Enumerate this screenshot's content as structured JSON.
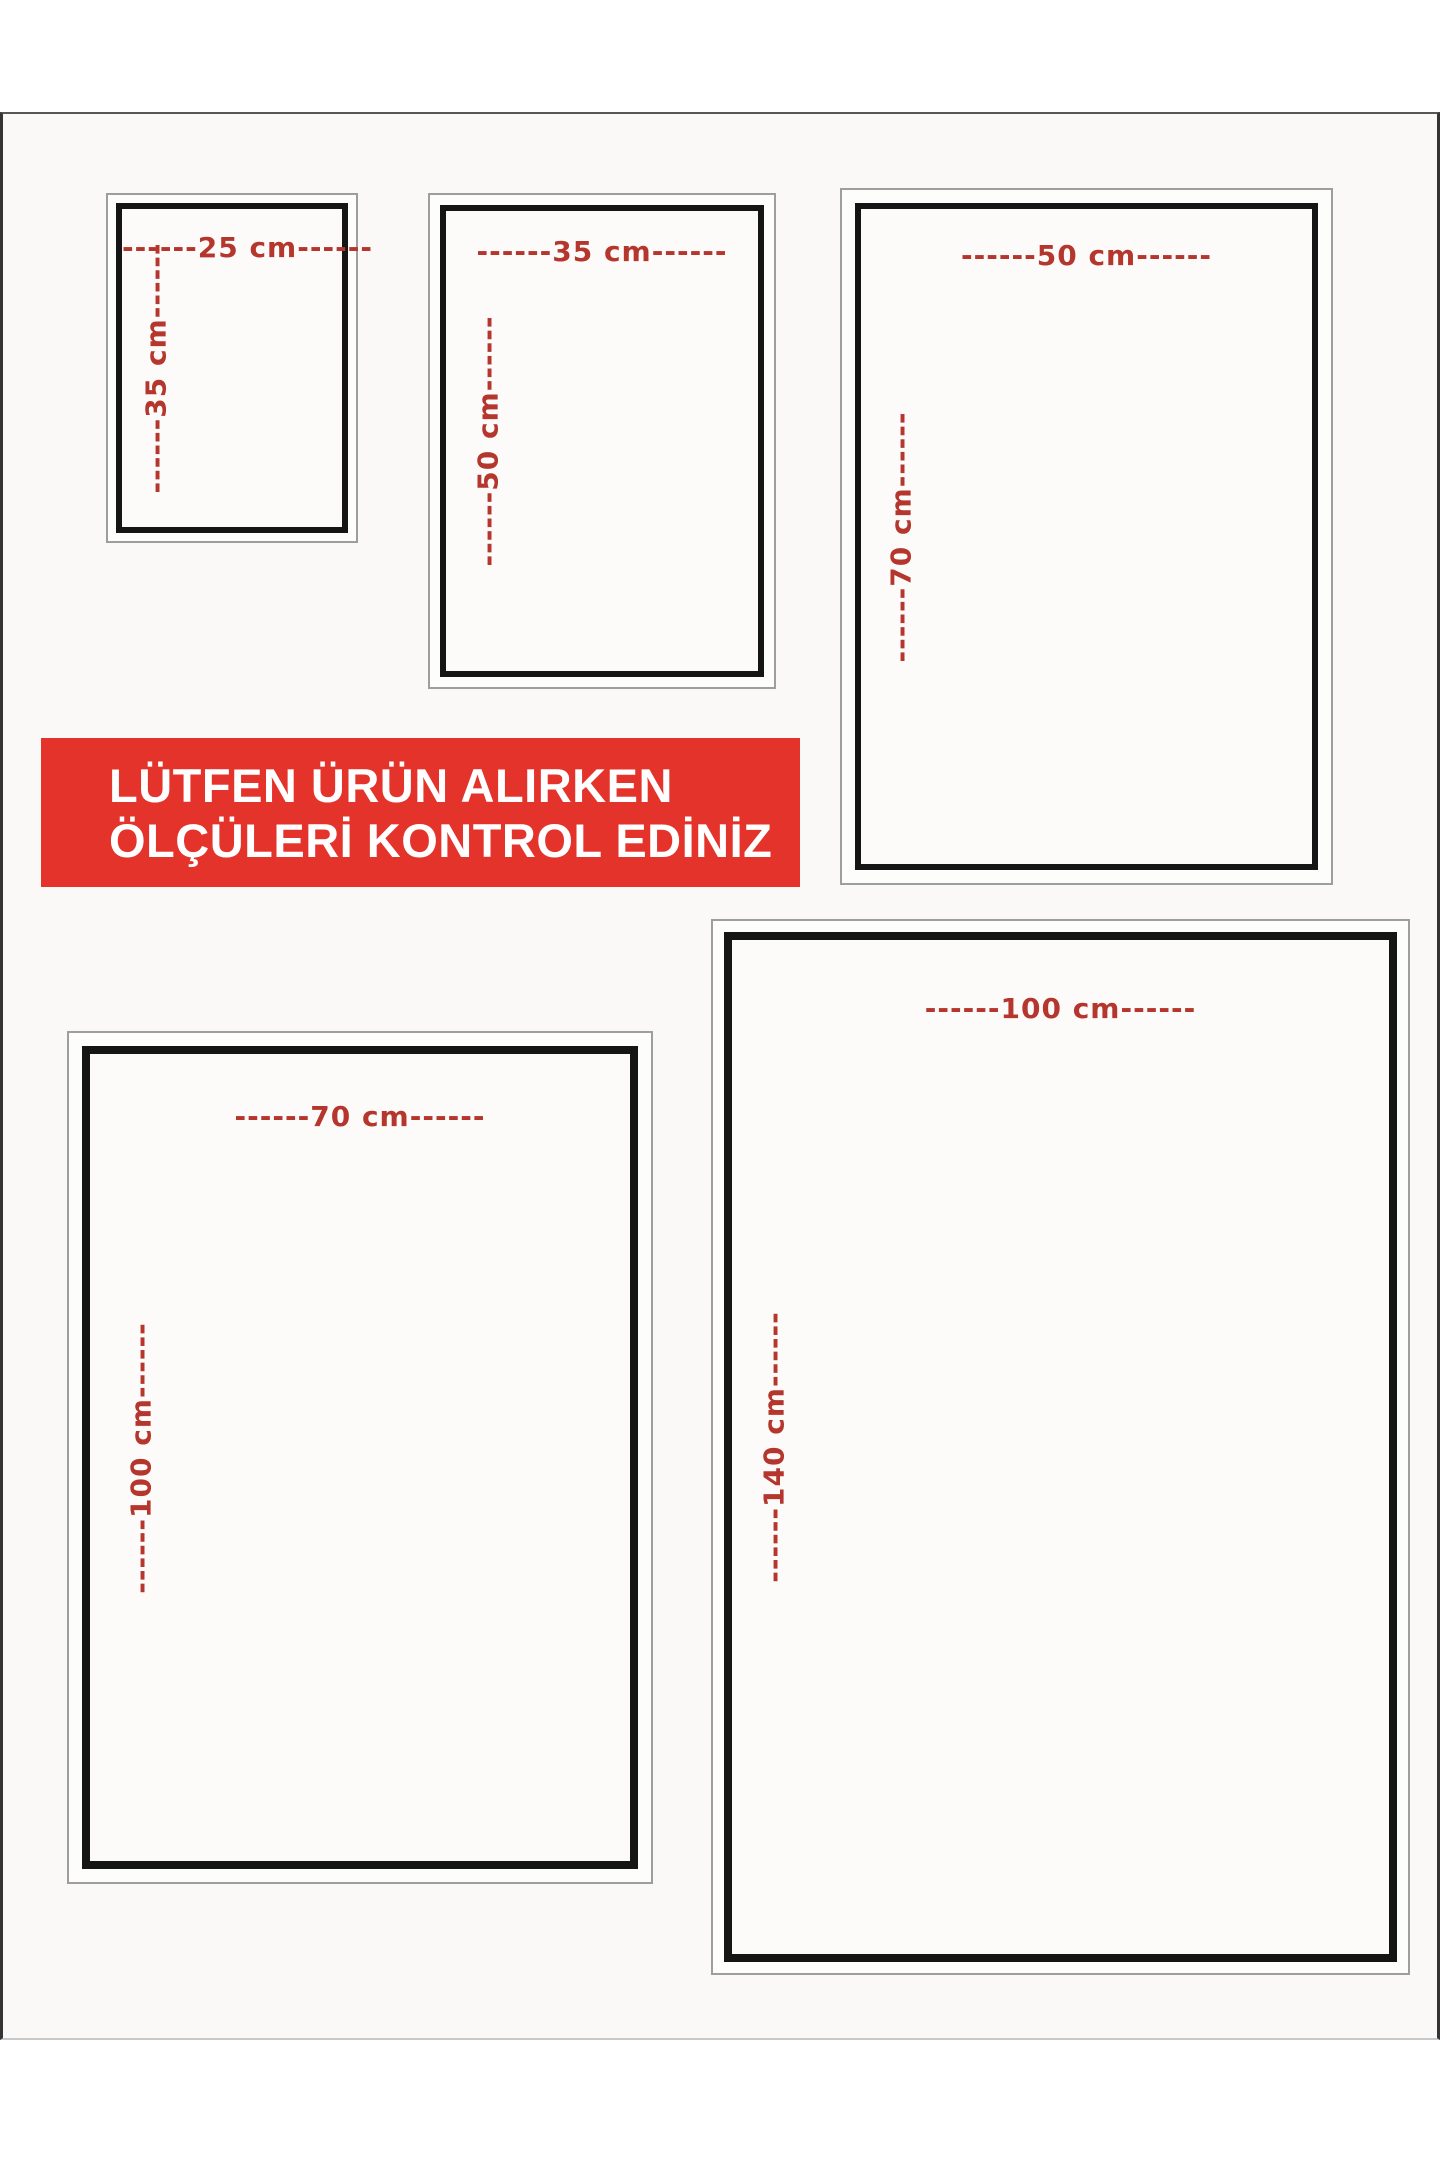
{
  "colors": {
    "accent_red": "#b5362d",
    "banner_bg": "#e4332b",
    "banner_text": "#ffffff",
    "frame_border_dark": "#151515",
    "frame_border_light": "#9e9e9e",
    "photo_bg": "#faf9f7"
  },
  "banner": {
    "line1": "LÜTFEN ÜRÜN ALIRKEN",
    "line2": "ÖLÇÜLERİ KONTROL EDİNİZ"
  },
  "frames": [
    {
      "id": "25x35",
      "width_cm": 25,
      "height_cm": 35,
      "width_label": "------25 cm------",
      "height_label": "------35 cm------"
    },
    {
      "id": "35x50",
      "width_cm": 35,
      "height_cm": 50,
      "width_label": "------35 cm------",
      "height_label": "------50 cm------"
    },
    {
      "id": "50x70",
      "width_cm": 50,
      "height_cm": 70,
      "width_label": "------50 cm------",
      "height_label": "------70 cm------"
    },
    {
      "id": "70x100",
      "width_cm": 70,
      "height_cm": 100,
      "width_label": "------70 cm------",
      "height_label": "------100 cm------"
    },
    {
      "id": "100x140",
      "width_cm": 100,
      "height_cm": 140,
      "width_label": "------100 cm------",
      "height_label": "------140 cm------"
    }
  ]
}
